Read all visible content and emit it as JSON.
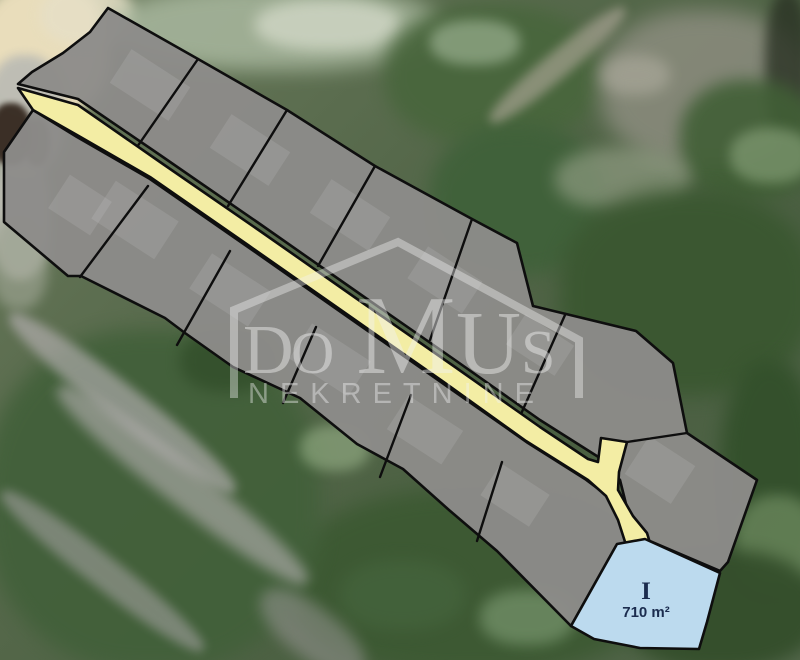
{
  "watermark": {
    "brand_main": "DOMUS",
    "letters": [
      "D",
      "O",
      "M",
      "U",
      "S"
    ],
    "brand_sub": "NEKRETNINE",
    "color": "#f2f2f2"
  },
  "highlight_plot": {
    "id_label": "I",
    "area_label": "710 m²",
    "fill": "#bcdaee",
    "text_color": "#1b2c4e"
  },
  "map": {
    "outline_color": "#0e0e0e",
    "plot_fill": "#8d8b89",
    "road_fill": "#f3eda4",
    "road_points": "18,88 78,105 160,162 260,231 360,301 455,367 540,427 588,459 598,462 601,438 627,442 619,472 618,490 633,516 647,533 650,543 627,548 618,520 606,496 588,480 526,441 448,385 348,315 248,245 150,177 77,135 33,110",
    "upper_band_points": "108,8 198,59 287,110 375,166 472,219 517,243 533,306 636,331 673,363 687,433 757,480 728,562 720,571 645,539 630,520 620,480 600,458 540,420 455,360 360,294 260,224 160,155 78,99 18,84 32,72 63,53 90,32",
    "lower_band_points": "33,110 77,137 150,179 248,247 348,317 448,387 528,443 585,479 605,494 618,515 627,545 616,546 571,626 497,551 449,510 403,469 357,444 300,398 233,367 185,333 165,318 81,276 68,276 4,222 4,152",
    "highlight_points": "645,539 720,573 707,622 699,649 640,648 594,639 571,626 617,544",
    "dividers": [
      "198,59 137,147",
      "287,110 228,206",
      "375,166 318,266",
      "472,219 430,340",
      "565,315 521,414",
      "627,442 687,433",
      "148,186 80,277",
      "230,251 177,345",
      "316,327 283,403",
      "411,395 380,477",
      "502,462 477,541"
    ],
    "ghost_buildings": [
      [
        150,
        85,
        70,
        40
      ],
      [
        250,
        150,
        70,
        40
      ],
      [
        350,
        215,
        70,
        40
      ],
      [
        445,
        280,
        65,
        38
      ],
      [
        540,
        345,
        58,
        36
      ],
      [
        135,
        220,
        75,
        45
      ],
      [
        230,
        290,
        70,
        42
      ],
      [
        330,
        360,
        70,
        42
      ],
      [
        425,
        430,
        65,
        40
      ],
      [
        515,
        495,
        58,
        38
      ],
      [
        80,
        205,
        50,
        40
      ],
      [
        660,
        470,
        55,
        45
      ]
    ]
  },
  "background": {
    "base_gradient": [
      "#6b7a5c",
      "#55684a",
      "#4a5f41",
      "#52664a"
    ],
    "patches": [
      [
        -25,
        -20,
        135,
        140,
        "#e9ddbb",
        1,
        7,
        0
      ],
      [
        40,
        -15,
        95,
        60,
        "#e6dfc6",
        0.9,
        6,
        0
      ],
      [
        -15,
        55,
        80,
        120,
        "#bcbcb4",
        0.95,
        5,
        0
      ],
      [
        -10,
        150,
        60,
        130,
        "#c2c1b9",
        0.9,
        5,
        0
      ],
      [
        -10,
        103,
        42,
        62,
        "#2e2118",
        0.9,
        3,
        0
      ],
      [
        24,
        118,
        26,
        48,
        "#3a2a1e",
        0.8,
        3,
        0
      ],
      [
        -10,
        215,
        58,
        95,
        "#9aa18f",
        0.7,
        6,
        0
      ],
      [
        110,
        -15,
        330,
        85,
        "#a9b89f",
        0.85,
        10,
        0
      ],
      [
        255,
        0,
        145,
        50,
        "#d8ddcd",
        0.7,
        7,
        0
      ],
      [
        385,
        5,
        215,
        140,
        "#49663d",
        0.95,
        9,
        0
      ],
      [
        430,
        125,
        175,
        150,
        "#40613a",
        0.95,
        9,
        0
      ],
      [
        600,
        10,
        210,
        155,
        "#8c8d7f",
        0.85,
        11,
        0
      ],
      [
        765,
        -10,
        45,
        150,
        "#2a3224",
        0.8,
        6,
        0
      ],
      [
        680,
        80,
        140,
        120,
        "#415f36",
        0.9,
        8,
        0
      ],
      [
        470,
        52,
        175,
        26,
        "#b4ab9e",
        0.6,
        5,
        -40
      ],
      [
        555,
        148,
        135,
        62,
        "#9aa48c",
        0.6,
        8,
        0
      ],
      [
        430,
        20,
        90,
        45,
        "#b9ccb0",
        0.5,
        6,
        0
      ],
      [
        600,
        55,
        70,
        40,
        "#b0ada0",
        0.6,
        7,
        0
      ],
      [
        560,
        190,
        255,
        205,
        "#3a5730",
        0.92,
        10,
        0
      ],
      [
        720,
        360,
        100,
        235,
        "#33502b",
        0.95,
        9,
        0
      ],
      [
        735,
        495,
        85,
        95,
        "#7c996c",
        0.6,
        7,
        0
      ],
      [
        620,
        550,
        200,
        120,
        "#344e2b",
        0.95,
        8,
        0
      ],
      [
        290,
        490,
        365,
        185,
        "#3c5932",
        0.92,
        10,
        0
      ],
      [
        -15,
        330,
        335,
        340,
        "#42603a",
        0.93,
        10,
        0
      ],
      [
        -20,
        385,
        285,
        36,
        "#beb6bb",
        0.6,
        5,
        38
      ],
      [
        25,
        465,
        315,
        40,
        "#c2b9bf",
        0.55,
        6,
        38
      ],
      [
        -25,
        555,
        255,
        32,
        "#b3abb1",
        0.5,
        5,
        38
      ],
      [
        300,
        425,
        70,
        46,
        "#9fb98f",
        0.55,
        6,
        0
      ],
      [
        480,
        590,
        95,
        55,
        "#8fae85",
        0.5,
        7,
        0
      ],
      [
        730,
        128,
        82,
        55,
        "#9ab38b",
        0.5,
        6,
        0
      ],
      [
        180,
        330,
        95,
        62,
        "#324e2a",
        0.8,
        7,
        0
      ],
      [
        340,
        560,
        125,
        70,
        "#44633c",
        0.8,
        8,
        0
      ],
      [
        250,
        608,
        125,
        50,
        "#a8a1a6",
        0.45,
        7,
        38
      ]
    ]
  }
}
